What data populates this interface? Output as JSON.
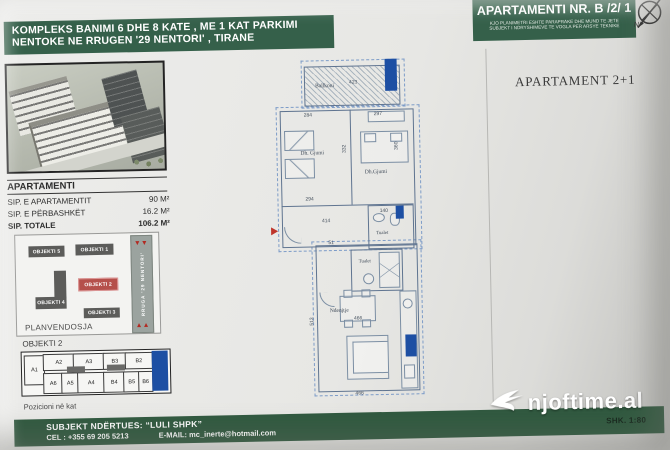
{
  "header": {
    "left": {
      "line1": "KOMPLEKS BANIMI 6 DHE 8 KATE , ME 1 KAT PARKIMI",
      "line2": "NENTOKE NE RRUGEN '29 NENTORI' , TIRANE"
    },
    "right": {
      "title": "APARTAMENTI NR. B /2/ 1",
      "disclaimer1": "KJO PLANIMETRI ESHTE PARAPRAKE DHE MUND TE JETE",
      "disclaimer2": "SUBJEKT I NDRYSHIMEVE TE VOGLA PER ARSYE TEKNIKE",
      "north": "N"
    }
  },
  "info": {
    "title": "APARTAMENTI",
    "rows": [
      {
        "label": "SIP. E APARTAMENTIT",
        "value": "90 M²"
      },
      {
        "label": "SIP. E PËRBASHKËT",
        "value": "16.2 M²"
      },
      {
        "label": "SIP. TOTALE",
        "value": "106.2 M²"
      }
    ]
  },
  "site": {
    "title": "PLANVENDOSJA",
    "obj1": "OBJEKTI 1",
    "obj2": "OBJEKTI 2",
    "obj3": "OBJEKTI 3",
    "obj4": "OBJEKTI 4",
    "obj5": "OBJEKTI 5",
    "road": "RRUGA '29 NENTORI'"
  },
  "strip": {
    "title": "OBJEKTI 2",
    "caption": "Pozicioni në kat",
    "top": [
      "A1",
      "A2",
      "A3",
      "B3",
      "B2"
    ],
    "bottom": [
      "A6",
      "A5",
      "A4",
      "B4",
      "B5",
      "B6"
    ]
  },
  "plan": {
    "title": "APARTAMENT 2+1",
    "rooms": {
      "balcony": "Ballkoni",
      "bedroom1": "Dh. Gjumi",
      "bedroom2": "Dh.Gjumi",
      "toilet1": "Tualet",
      "toilet2": "Tualet",
      "living": "Ndenjtje"
    },
    "dims": {
      "balcony_w": "423",
      "bed1_top": "284",
      "bed1_bottom": "294",
      "bed1_side": "332",
      "bed2_top": "297",
      "bed2_side": "360",
      "corridor": "414",
      "toilet_top": "140",
      "entry": "51",
      "living_w": "466",
      "living_side": "513",
      "living_bottom": "466"
    }
  },
  "footer": {
    "builder": "SUBJEKT NDËRTUES: “LULI SHPK”",
    "phone": "CEL : +355 69 205 5213",
    "email": "E-MAIL: mc_inerte@hotmail.com",
    "scale": "SHK. 1:80",
    "watermark": "njoftime.al"
  },
  "colors": {
    "banner_green": "#35604a",
    "object_red": "#b5504b",
    "highlight_blue": "#1d4fa3",
    "road_gray": "#9ba39f"
  }
}
